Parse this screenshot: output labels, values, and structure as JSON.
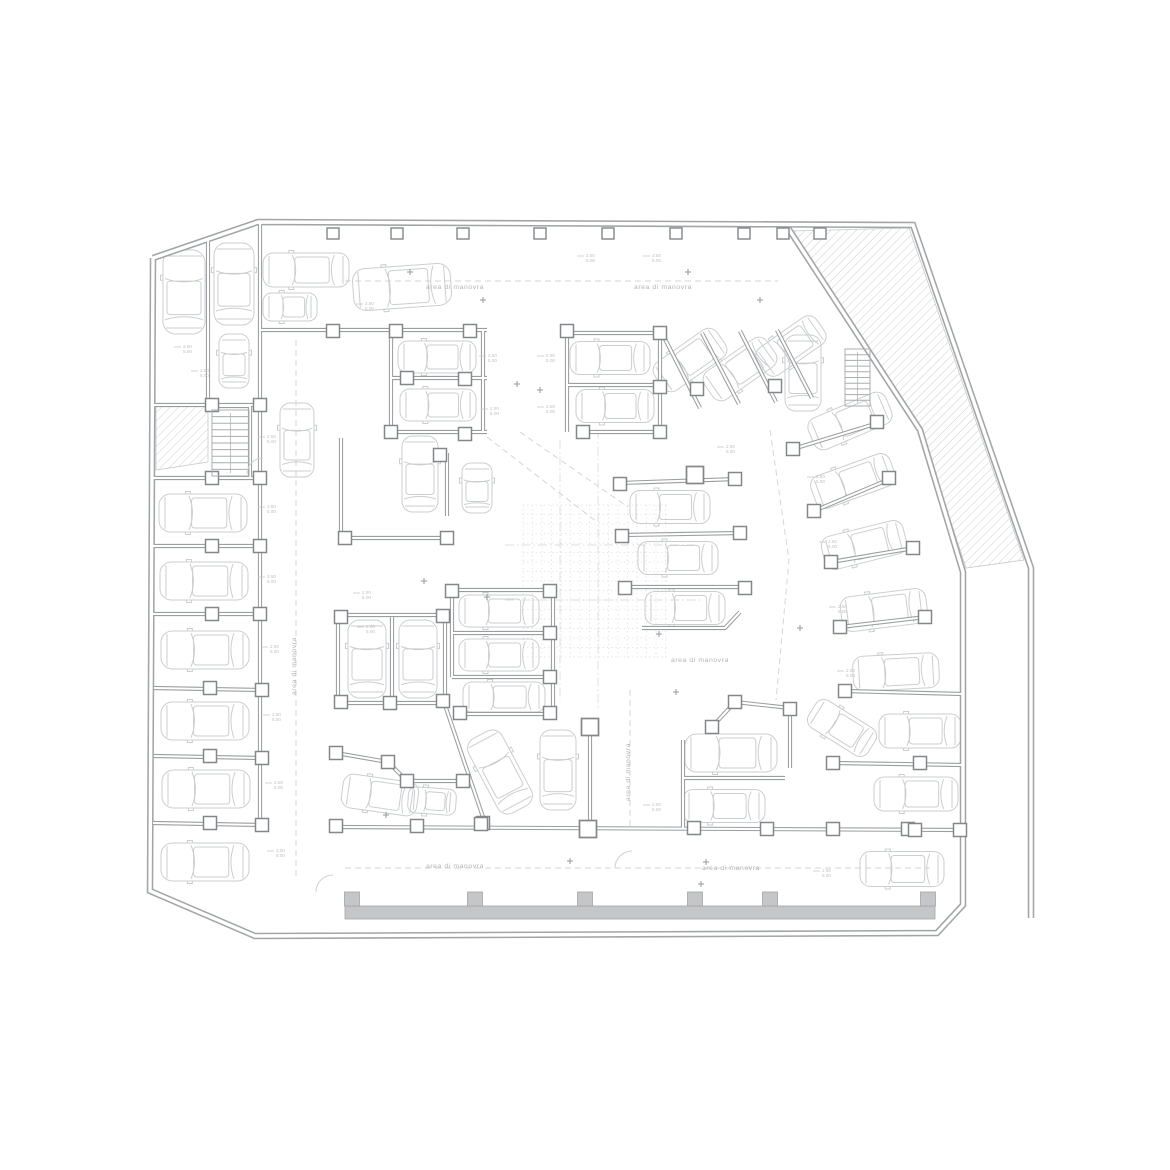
{
  "meta": {
    "drawing_type": "basement parking floor plan"
  },
  "palette": {
    "bg": "#ffffff",
    "wall_outer": "#a2a5a8",
    "wall_inner": "#9b9ea1",
    "wall_core": "#ffffff",
    "column_stroke": "#83878a",
    "column_fill": "#ffffff",
    "car": "#cbced0",
    "hatch": "#c7c9cb",
    "band": "#c5c6c7",
    "text": "#b1b3b5",
    "dim_text": "#bfc1c3",
    "dashed": "#d4d6d8",
    "grid": "#dcddde",
    "cross": "#9da1a4",
    "stair": "#aaadaf",
    "arc": "#cfd1d3"
  },
  "labels": {
    "aisle": "area di manovra",
    "dim_line1": "2.50",
    "dim_line2": "5.00"
  },
  "aisle_labels": [
    {
      "x": 455,
      "y": 289,
      "vertical": false
    },
    {
      "x": 663,
      "y": 289,
      "vertical": false
    },
    {
      "x": 296,
      "y": 666,
      "vertical": true
    },
    {
      "x": 700,
      "y": 662,
      "vertical": false
    },
    {
      "x": 630,
      "y": 772,
      "vertical": true
    },
    {
      "x": 455,
      "y": 868,
      "vertical": false
    },
    {
      "x": 731,
      "y": 870,
      "vertical": false
    }
  ],
  "dim_labels": [
    [
      183,
      348
    ],
    [
      200,
      372
    ],
    [
      267,
      438
    ],
    [
      267,
      508
    ],
    [
      267,
      578
    ],
    [
      270,
      648
    ],
    [
      272,
      716
    ],
    [
      274,
      784
    ],
    [
      276,
      852
    ],
    [
      365,
      305
    ],
    [
      488,
      357
    ],
    [
      546,
      357
    ],
    [
      490,
      410
    ],
    [
      546,
      408
    ],
    [
      362,
      594
    ],
    [
      366,
      628
    ],
    [
      652,
      806
    ],
    [
      816,
      478
    ],
    [
      828,
      543
    ],
    [
      838,
      608
    ],
    [
      846,
      672
    ],
    [
      726,
      448
    ],
    [
      652,
      257
    ],
    [
      586,
      257
    ],
    [
      822,
      872
    ]
  ],
  "cross_markers": [
    [
      410,
      272
    ],
    [
      483,
      300
    ],
    [
      688,
      272
    ],
    [
      760,
      300
    ],
    [
      517,
      384
    ],
    [
      540,
      390
    ],
    [
      424,
      581
    ],
    [
      487,
      597
    ],
    [
      659,
      634
    ],
    [
      676,
      692
    ],
    [
      800,
      628
    ],
    [
      386,
      815
    ],
    [
      570,
      861
    ],
    [
      706,
      862
    ],
    [
      701,
      884
    ]
  ],
  "walls": {
    "outer": [
      "153,258 258,222 913,225 1031,568 1031,918",
      "153,258 150,891 255,936 937,933 963,905 963,572 920,430 788,228"
    ],
    "inner": [
      "260,222 260,828",
      "208,240 208,406",
      "153,405 260,405",
      "153,478 260,478",
      "153,546 260,546",
      "153,614 260,614",
      "154,688 262,690",
      "154,756 262,758",
      "153,823 262,825",
      "260,330 487,330",
      "391,330 391,432",
      "391,378 487,378",
      "391,432 487,432",
      "483,330 483,432",
      "447,453 447,516",
      "341,438 341,538",
      "341,538 447,538",
      "338,615 445,615",
      "445,615 445,703",
      "445,703 338,703",
      "338,703 338,615",
      "392,617 392,701",
      "336,753 388,762 407,781 463,781",
      "445,705 485,823",
      "336,827 963,830",
      "452,590 553,590",
      "452,633 553,633",
      "452,677 553,677",
      "460,714 553,714",
      "553,590 553,714",
      "452,590 452,677",
      "567,330 567,432",
      "660,333 660,432",
      "567,333 660,333",
      "567,385 660,385",
      "580,432 667,432",
      "663,335 700,408",
      "702,333 739,404",
      "740,331 776,402",
      "777,330 812,398",
      "620,483 737,479",
      "622,535 742,533",
      "625,587 747,587",
      "642,628 725,628 740,612",
      "793,449 878,423",
      "814,511 890,479",
      "831,562 914,548",
      "840,627 926,617",
      "845,691 963,694",
      "833,763 963,765",
      "712,727 735,702 790,708",
      "790,708 790,768",
      "683,778 785,778",
      "683,740 683,828",
      "590,727 590,830",
      "208,406 250,406 250,478"
    ]
  },
  "columns": [
    [
      333,
      331
    ],
    [
      396,
      331
    ],
    [
      470,
      331
    ],
    [
      212,
      405
    ],
    [
      260,
      405
    ],
    [
      212,
      478
    ],
    [
      260,
      478
    ],
    [
      212,
      546
    ],
    [
      260,
      546
    ],
    [
      212,
      614
    ],
    [
      260,
      614
    ],
    [
      210,
      688
    ],
    [
      262,
      690
    ],
    [
      210,
      756
    ],
    [
      262,
      758
    ],
    [
      210,
      823
    ],
    [
      262,
      825
    ],
    [
      407,
      378
    ],
    [
      465,
      379
    ],
    [
      391,
      432
    ],
    [
      465,
      434
    ],
    [
      440,
      455
    ],
    [
      345,
      538
    ],
    [
      447,
      538
    ],
    [
      341,
      617
    ],
    [
      443,
      616
    ],
    [
      341,
      702
    ],
    [
      390,
      703
    ],
    [
      443,
      701
    ],
    [
      336,
      753
    ],
    [
      388,
      762
    ],
    [
      407,
      781
    ],
    [
      463,
      781
    ],
    [
      483,
      823
    ],
    [
      336,
      826
    ],
    [
      417,
      826
    ],
    [
      481,
      824
    ],
    [
      694,
      828
    ],
    [
      767,
      829
    ],
    [
      833,
      829
    ],
    [
      908,
      829
    ],
    [
      960,
      830
    ],
    [
      452,
      591
    ],
    [
      550,
      591
    ],
    [
      550,
      633
    ],
    [
      550,
      677
    ],
    [
      460,
      713
    ],
    [
      550,
      713
    ],
    [
      567,
      331
    ],
    [
      660,
      333
    ],
    [
      660,
      387
    ],
    [
      583,
      432
    ],
    [
      660,
      432
    ],
    [
      697,
      389
    ],
    [
      775,
      386
    ],
    [
      735,
      479
    ],
    [
      740,
      533
    ],
    [
      745,
      588
    ],
    [
      620,
      484
    ],
    [
      622,
      536
    ],
    [
      625,
      588
    ],
    [
      793,
      449
    ],
    [
      814,
      511
    ],
    [
      831,
      562
    ],
    [
      840,
      627
    ],
    [
      845,
      691
    ],
    [
      833,
      763
    ],
    [
      877,
      422
    ],
    [
      889,
      478
    ],
    [
      913,
      548
    ],
    [
      925,
      617
    ],
    [
      920,
      763
    ],
    [
      915,
      830
    ],
    [
      712,
      727
    ],
    [
      735,
      702
    ],
    [
      790,
      709
    ]
  ],
  "big_columns": [
    [
      695,
      475
    ],
    [
      590,
      727
    ],
    [
      588,
      829
    ]
  ],
  "top_pilasters": [
    333,
    397,
    463,
    540,
    608,
    676,
    744,
    783,
    820
  ],
  "band": {
    "x": 345,
    "y": 906,
    "w": 590,
    "h": 13,
    "pilasters": [
      352,
      475,
      585,
      695,
      770,
      928
    ],
    "pw": 15,
    "ph": 14
  },
  "cars": [
    [
      184,
      292,
      84,
      42,
      90
    ],
    [
      234,
      284,
      82,
      40,
      90
    ],
    [
      234,
      361,
      54,
      30,
      90
    ],
    [
      203,
      513,
      88,
      38,
      0
    ],
    [
      204,
      581,
      88,
      38,
      0
    ],
    [
      205,
      650,
      88,
      38,
      0
    ],
    [
      205,
      721,
      88,
      38,
      0
    ],
    [
      206,
      789,
      88,
      38,
      0
    ],
    [
      205,
      862,
      88,
      38,
      0
    ],
    [
      306,
      270,
      86,
      34,
      0
    ],
    [
      290,
      307,
      54,
      28,
      0
    ],
    [
      402,
      287,
      98,
      42,
      -4
    ],
    [
      297,
      440,
      74,
      34,
      90
    ],
    [
      437,
      357,
      78,
      32,
      0
    ],
    [
      438,
      405,
      76,
      32,
      0
    ],
    [
      420,
      474,
      76,
      36,
      90
    ],
    [
      477,
      488,
      50,
      30,
      90
    ],
    [
      367,
      659,
      78,
      38,
      90
    ],
    [
      418,
      659,
      78,
      38,
      90
    ],
    [
      380,
      795,
      76,
      34,
      8
    ],
    [
      432,
      801,
      48,
      26,
      4
    ],
    [
      500,
      772,
      84,
      38,
      62
    ],
    [
      558,
      770,
      80,
      36,
      90
    ],
    [
      499,
      611,
      80,
      32,
      0
    ],
    [
      499,
      655,
      80,
      32,
      0
    ],
    [
      504,
      697,
      82,
      30,
      0
    ],
    [
      670,
      507,
      80,
      33,
      0
    ],
    [
      678,
      558,
      80,
      33,
      0
    ],
    [
      685,
      608,
      80,
      33,
      0
    ],
    [
      610,
      358,
      80,
      33,
      0
    ],
    [
      615,
      406,
      78,
      33,
      0
    ],
    [
      690,
      360,
      76,
      34,
      -35
    ],
    [
      740,
      369,
      76,
      34,
      -35
    ],
    [
      791,
      346,
      72,
      33,
      -35
    ],
    [
      803,
      373,
      76,
      36,
      90
    ],
    [
      850,
      421,
      84,
      34,
      -23
    ],
    [
      853,
      481,
      84,
      34,
      -20
    ],
    [
      864,
      545,
      84,
      34,
      -14
    ],
    [
      884,
      610,
      86,
      35,
      -7
    ],
    [
      896,
      672,
      86,
      35,
      -3
    ],
    [
      920,
      731,
      82,
      34,
      0
    ],
    [
      916,
      794,
      84,
      34,
      0
    ],
    [
      902,
      869,
      84,
      35,
      0
    ],
    [
      842,
      728,
      70,
      32,
      32
    ],
    [
      731,
      753,
      92,
      38,
      0
    ],
    [
      724,
      806,
      82,
      33,
      0
    ]
  ],
  "stairs": [
    {
      "x": 212,
      "y": 410,
      "w": 37,
      "h": 66,
      "treads": 10,
      "horizontal": true
    },
    {
      "x": 845,
      "y": 349,
      "w": 25,
      "h": 57,
      "treads": 10,
      "horizontal": true
    }
  ],
  "hatches": [
    "792,231 909,228 1024,560 966,568 922,434",
    "156,405 208,405 208,462 156,470"
  ],
  "grid_region": {
    "x": 523,
    "y": 505,
    "w": 145,
    "h": 152,
    "step": 9.5
  },
  "dashed": [
    "345,281 778,281",
    "345,868 930,868",
    "296,340 296,880",
    "630,690 630,828",
    "487,437 597,522",
    "520,432 628,507",
    "770,430 789,560 776,700"
  ],
  "dashdot": [
    "560,440 560,700",
    "598,430 598,710",
    "505,545 695,545",
    "505,600 700,600"
  ],
  "door_arcs": [
    "M316,892 A17,17 0 0 1 333,875",
    "M615,868 A17,17 0 0 1 632,851",
    "M247,474 A16,16 0 0 1 263,458"
  ]
}
